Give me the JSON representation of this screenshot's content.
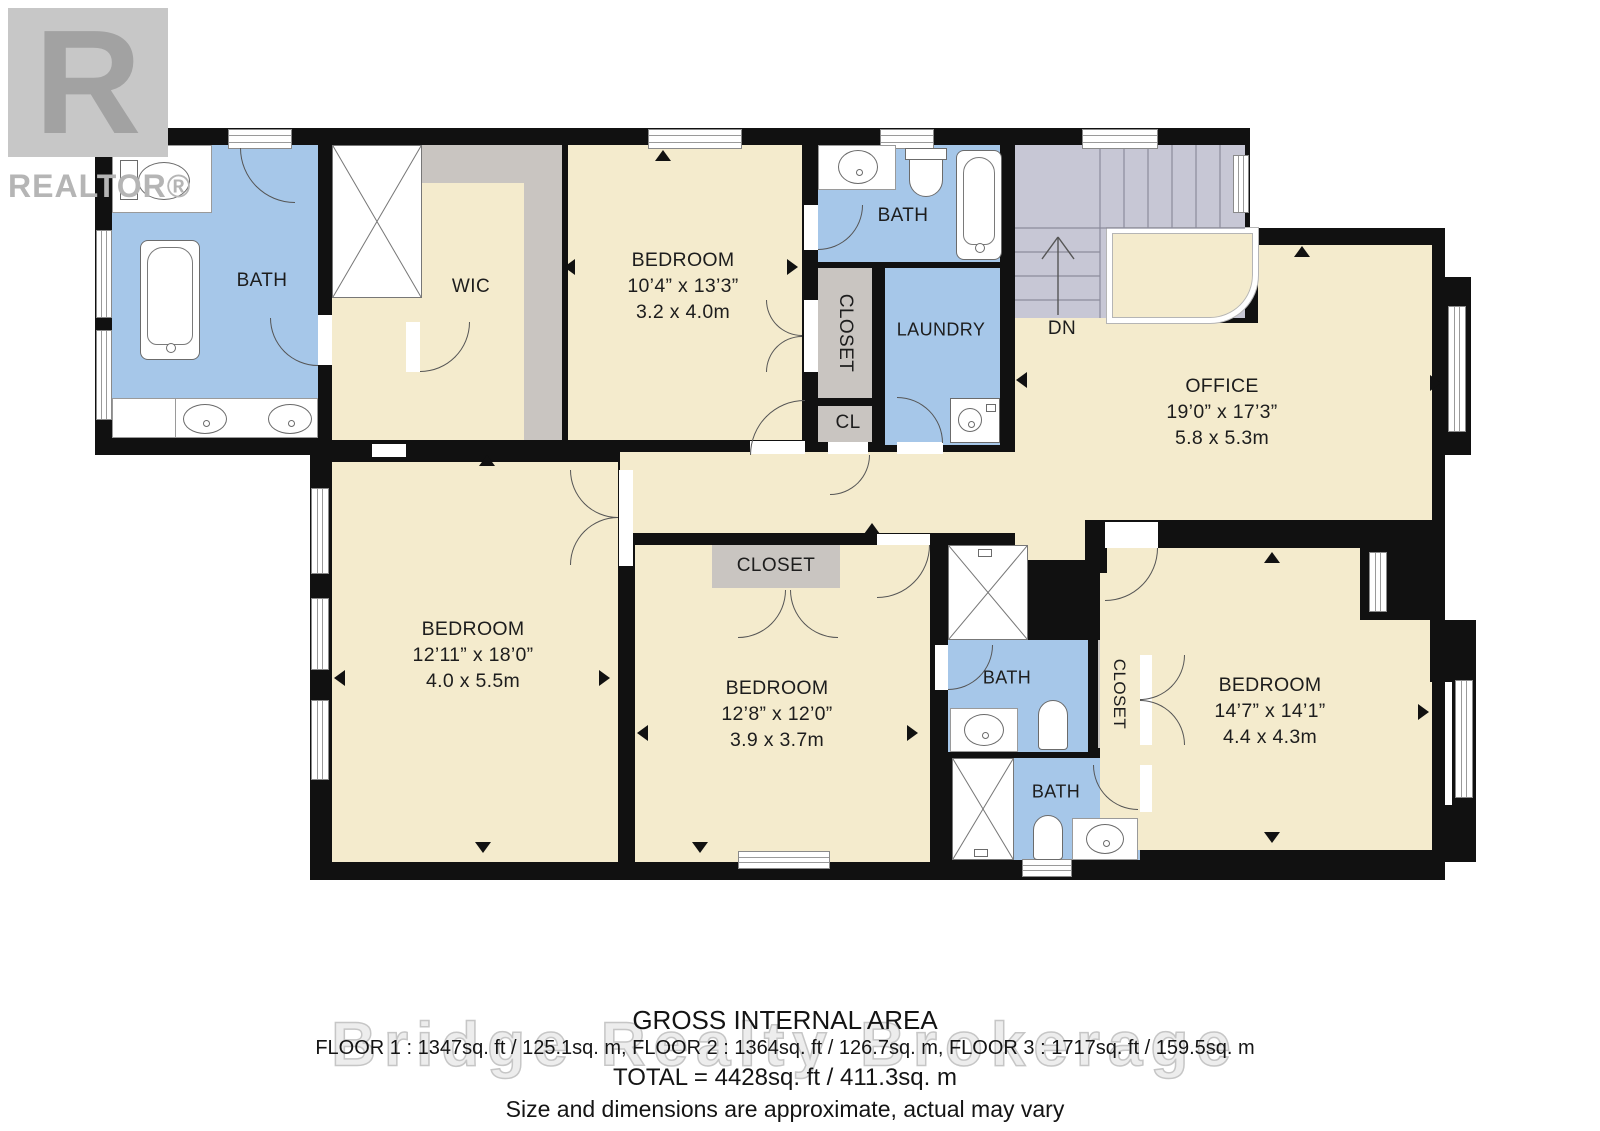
{
  "colors": {
    "floor": "#f4ebcd",
    "bath": "#a6c7e9",
    "closet": "#c9c5c1",
    "stairs": "#c7c7d5",
    "wall": "#111111"
  },
  "watermarks": {
    "logo_letter": "R",
    "logo_text": "REALTOR®",
    "brokerage": "Bridge Realty Brokerage"
  },
  "rooms": {
    "bath_master": {
      "label": "BATH"
    },
    "wic": {
      "label": "WIC"
    },
    "bedroom_top": {
      "label": "BEDROOM",
      "dim_ft": "10’4” x 13’3”",
      "dim_m": "3.2 x 4.0m"
    },
    "closet_hall": {
      "label": "CLOSET"
    },
    "closet_cl": {
      "label": "CL"
    },
    "bath_hall": {
      "label": "BATH"
    },
    "laundry": {
      "label": "LAUNDRY"
    },
    "stairs": {
      "label": "DN"
    },
    "office": {
      "label": "OFFICE",
      "dim_ft": "19’0” x 17’3”",
      "dim_m": "5.8 x 5.3m"
    },
    "bedroom_left": {
      "label": "BEDROOM",
      "dim_ft": "12’11” x 18’0”",
      "dim_m": "4.0 x 5.5m"
    },
    "closet_mid": {
      "label": "CLOSET"
    },
    "bedroom_mid": {
      "label": "BEDROOM",
      "dim_ft": "12’8” x 12’0”",
      "dim_m": "3.9 x 3.7m"
    },
    "bath_mid": {
      "label": "BATH"
    },
    "closet_right": {
      "label": "CLOSET"
    },
    "bath_lower": {
      "label": "BATH"
    },
    "bedroom_right": {
      "label": "BEDROOM",
      "dim_ft": "14’7” x 14’1”",
      "dim_m": "4.4 x 4.3m"
    }
  },
  "footer": {
    "title": "GROSS INTERNAL AREA",
    "floors": "FLOOR 1 : 1347sq. ft / 125.1sq. m, FLOOR 2 : 1364sq. ft / 126.7sq. m, FLOOR 3 : 1717sq. ft / 159.5sq. m",
    "total": "TOTAL = 4428sq. ft / 411.3sq. m",
    "disclaimer": "Size and dimensions are approximate, actual may vary"
  }
}
